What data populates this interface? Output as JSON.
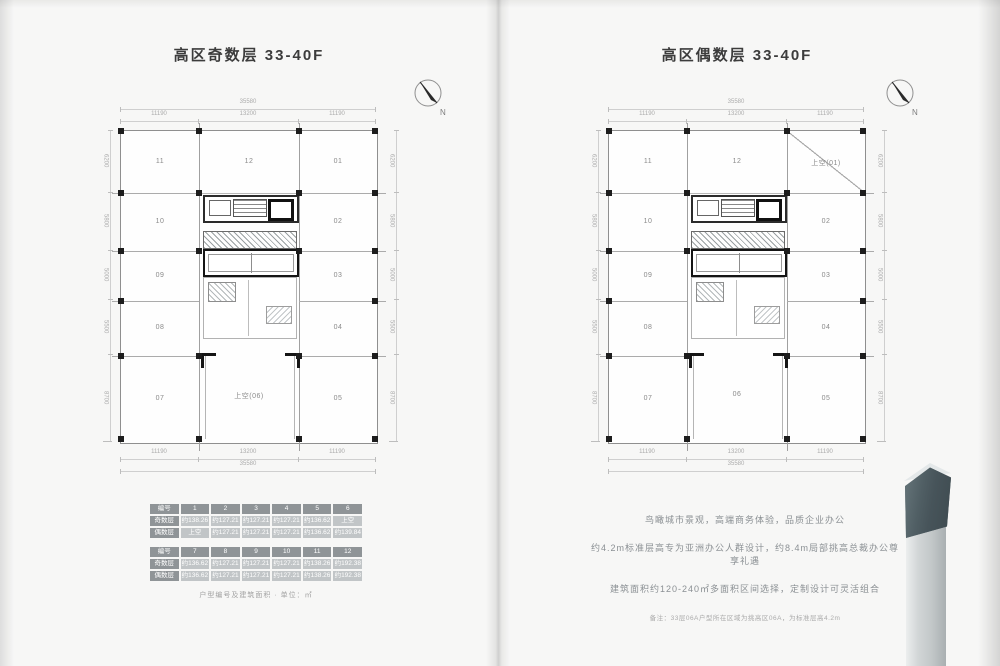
{
  "left": {
    "title": "高区奇数层  33-40F",
    "compass_label": "N",
    "plan": {
      "rooms": {
        "r11": "11",
        "r12": "12",
        "r01": "01",
        "r10": "10",
        "r02": "02",
        "r09": "09",
        "r03": "03",
        "r08": "08",
        "r04": "04",
        "r07": "07",
        "rc": "上空(06)",
        "r05": "05"
      },
      "dims": {
        "top_total": "35580",
        "top": [
          "11190",
          "13200",
          "11190"
        ],
        "bottom": [
          "11190",
          "13200",
          "11190"
        ],
        "bottom_total": "35580",
        "side": [
          "6200",
          "5800",
          "5000",
          "5500",
          "8700"
        ]
      }
    },
    "tables": [
      {
        "header": [
          "编号",
          "1",
          "2",
          "3",
          "4",
          "5",
          "6"
        ],
        "rows": [
          {
            "label": "奇数层",
            "values": [
              "约138.26",
              "约127.21",
              "约127.21",
              "约127.21",
              "约136.62",
              "上空"
            ]
          },
          {
            "label": "偶数层",
            "values": [
              "上空",
              "约127.21",
              "约127.21",
              "约127.21",
              "约136.62",
              "约139.84"
            ]
          }
        ]
      },
      {
        "header": [
          "编号",
          "7",
          "8",
          "9",
          "10",
          "11",
          "12"
        ],
        "rows": [
          {
            "label": "奇数层",
            "values": [
              "约136.62",
              "约127.21",
              "约127.21",
              "约127.21",
              "约138.26",
              "约192.38"
            ]
          },
          {
            "label": "偶数层",
            "values": [
              "约136.62",
              "约127.21",
              "约127.21",
              "约127.21",
              "约138.26",
              "约192.38"
            ]
          }
        ]
      }
    ],
    "caption": "户型编号及建筑面积 · 单位：㎡"
  },
  "right": {
    "title": "高区偶数层  33-40F",
    "compass_label": "N",
    "plan": {
      "rooms": {
        "r11": "11",
        "r12": "12",
        "r01": "上空(01)",
        "r10": "10",
        "r02": "02",
        "r09": "09",
        "r03": "03",
        "r08": "08",
        "r04": "04",
        "r07": "07",
        "rc": "06",
        "r05": "05"
      },
      "dims": {
        "top_total": "35580",
        "top": [
          "11190",
          "13200",
          "11190"
        ],
        "bottom": [
          "11190",
          "13200",
          "11190"
        ],
        "bottom_total": "35580",
        "side": [
          "6200",
          "5800",
          "5000",
          "5500",
          "8700"
        ]
      }
    },
    "paragraph": [
      "鸟瞰城市景观，高端商务体验，品质企业办公",
      "约4.2m标准层高专为亚洲办公人群设计，约8.4m局部挑高总裁办公尊享礼遇",
      "建筑面积约120-240㎡多面积区间选择，定制设计可灵活组合"
    ],
    "note": "备注：33层06A户型所在区域为挑高区06A，为标准层高4.2m"
  }
}
